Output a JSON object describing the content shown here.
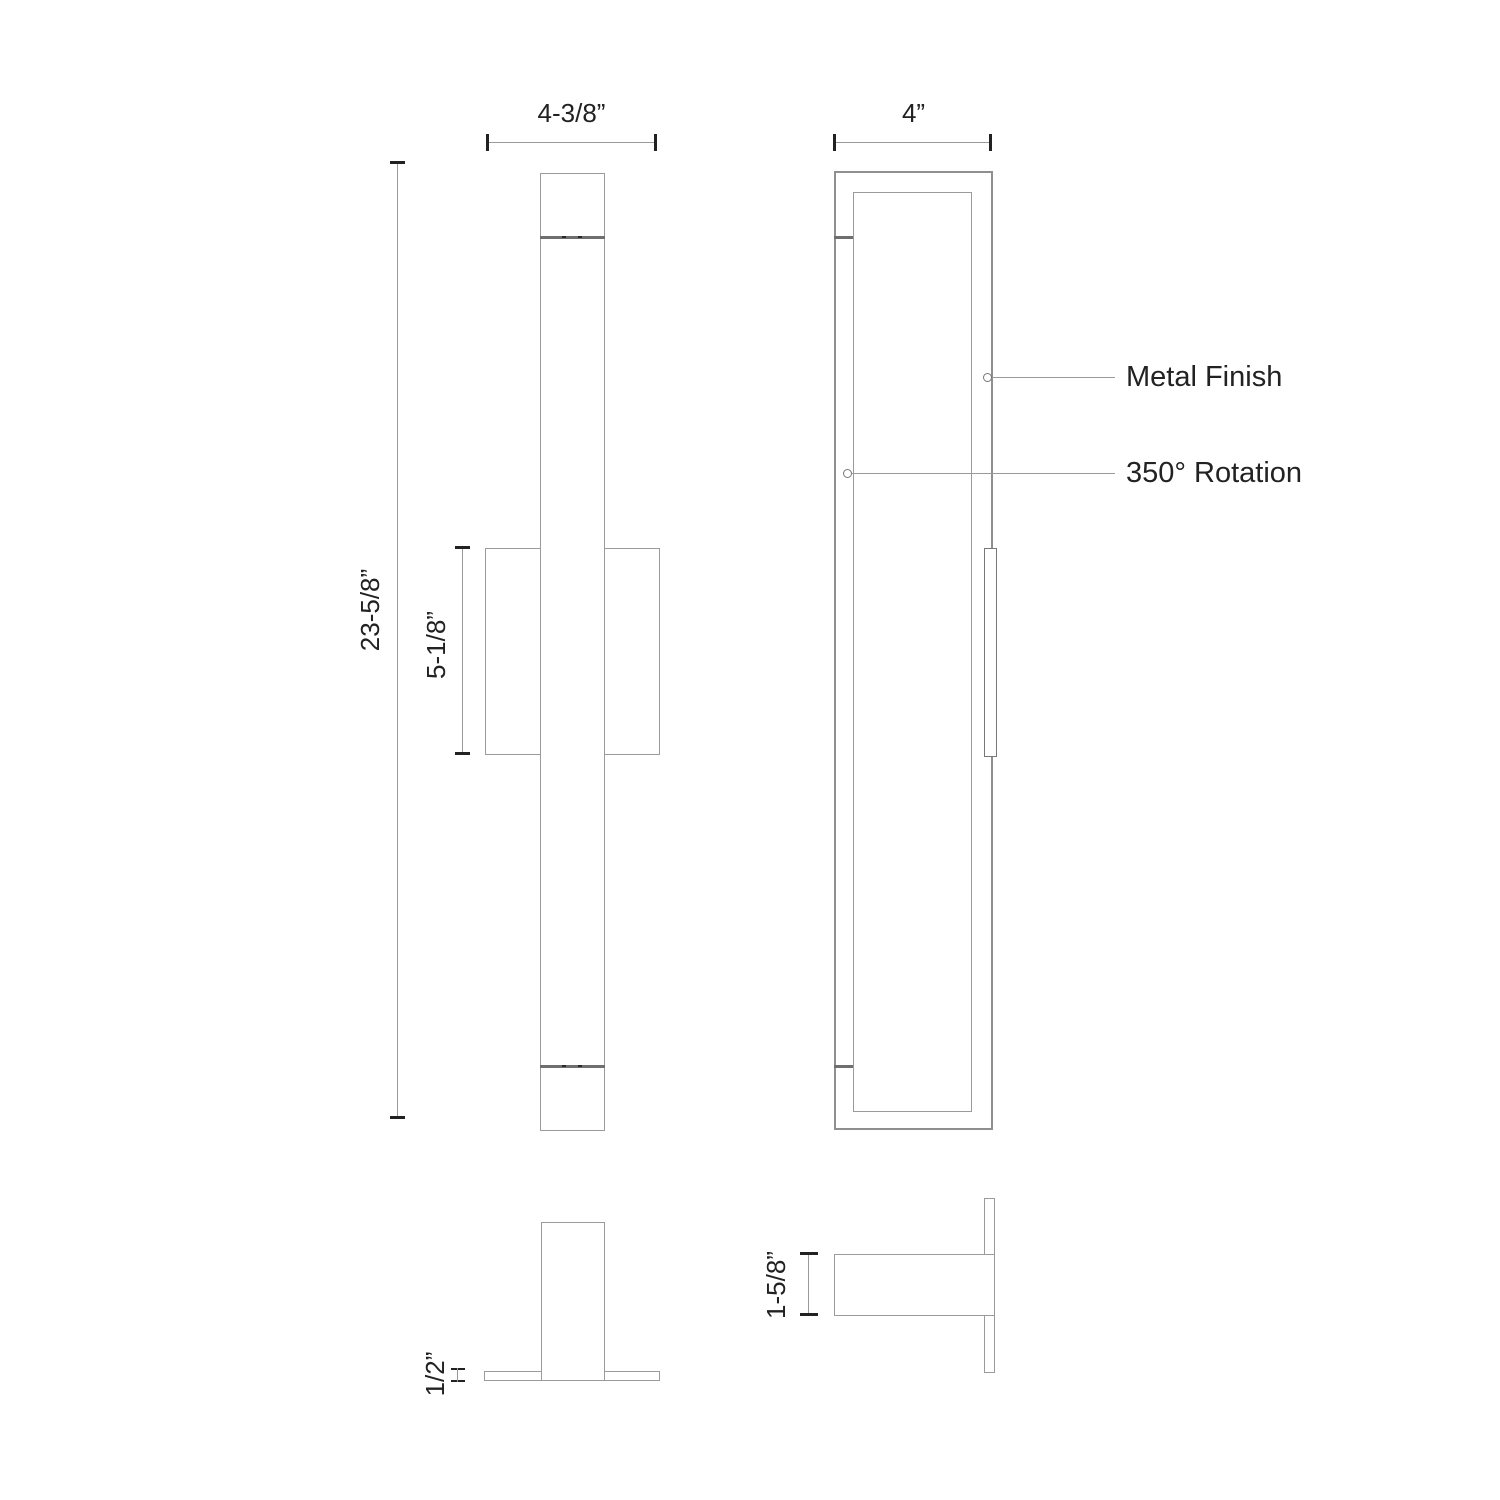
{
  "colors": {
    "line": "#9b9b9b",
    "divider_line": "#6f6f6f",
    "text": "#222222"
  },
  "front_view": {
    "width_dim_label": "4-3/8”",
    "height_dim_label": "23-5/8”",
    "backplate_dim_label": "5-1/8”"
  },
  "side_view": {
    "depth_dim_label": "4”",
    "callouts": [
      {
        "label": "Metal Finish"
      },
      {
        "label": "350° Rotation"
      }
    ]
  },
  "front_plan_view": {
    "plate_thickness_dim_label": "1/2”"
  },
  "side_plan_view": {
    "fixture_depth_dim_label": "1-5/8”"
  }
}
